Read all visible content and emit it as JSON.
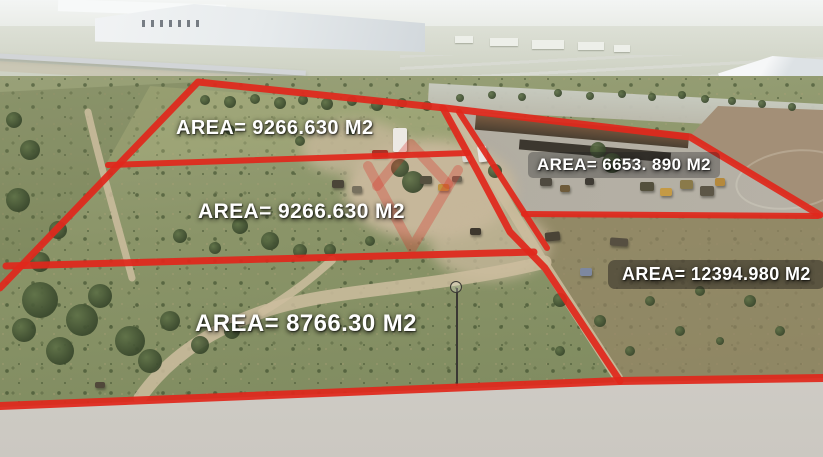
{
  "meta": {
    "type": "annotated aerial drone photograph",
    "subject": "industrial land parcels outlined in red with area measurements"
  },
  "colors": {
    "boundary_red": "#e0281c",
    "watermark_red": "#d93025",
    "label_text": "#ffffff"
  },
  "parcels": [
    {
      "name": "top-left-parcel",
      "label": "AREA= 9266.630 M2"
    },
    {
      "name": "middle-left-parcel",
      "label": "AREA= 9266.630 M2"
    },
    {
      "name": "bottom-left-parcel",
      "label": "AREA= 8766.30 M2"
    },
    {
      "name": "right-yard-parcel",
      "label": "AREA= 6653. 890 M2"
    },
    {
      "name": "right-field-parcel",
      "label": "AREA= 12394.980 M2"
    }
  ]
}
